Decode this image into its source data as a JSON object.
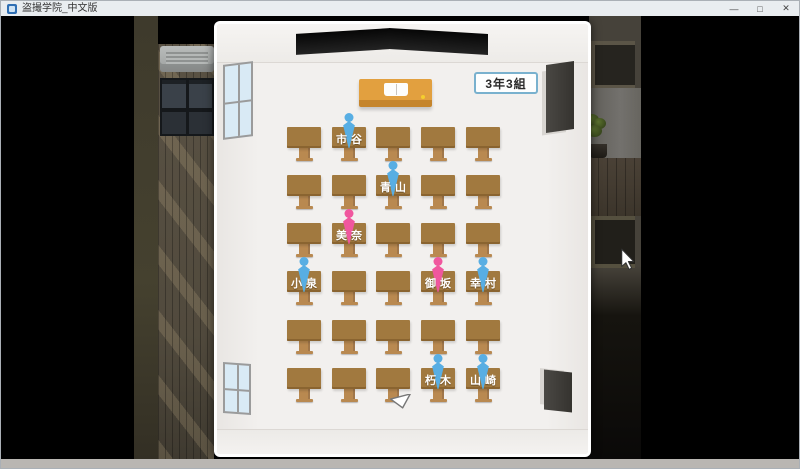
{
  "window": {
    "title": "盗撮学院_中文版",
    "minimize_label": "—",
    "maximize_label": "□",
    "close_label": "✕"
  },
  "classroom": {
    "class_label": "3年3組",
    "rows": 6,
    "cols": 5,
    "seats": [
      {
        "row": 0,
        "col": 1,
        "name": "市谷",
        "gender": "male"
      },
      {
        "row": 1,
        "col": 2,
        "name": "青山",
        "gender": "male"
      },
      {
        "row": 2,
        "col": 1,
        "name": "美奈",
        "gender": "female"
      },
      {
        "row": 3,
        "col": 0,
        "name": "小泉",
        "gender": "male"
      },
      {
        "row": 3,
        "col": 3,
        "name": "御坂",
        "gender": "female"
      },
      {
        "row": 3,
        "col": 4,
        "name": "幸村",
        "gender": "male"
      },
      {
        "row": 5,
        "col": 3,
        "name": "朽木",
        "gender": "male"
      },
      {
        "row": 5,
        "col": 4,
        "name": "山崎",
        "gender": "male"
      }
    ],
    "colors": {
      "male": "#58aee3",
      "female": "#f0579e",
      "desk_top": "#a1793f",
      "desk_leg": "#b98950",
      "teacher_desk": "#e2a03f",
      "badge_border": "#79b1ce"
    }
  }
}
